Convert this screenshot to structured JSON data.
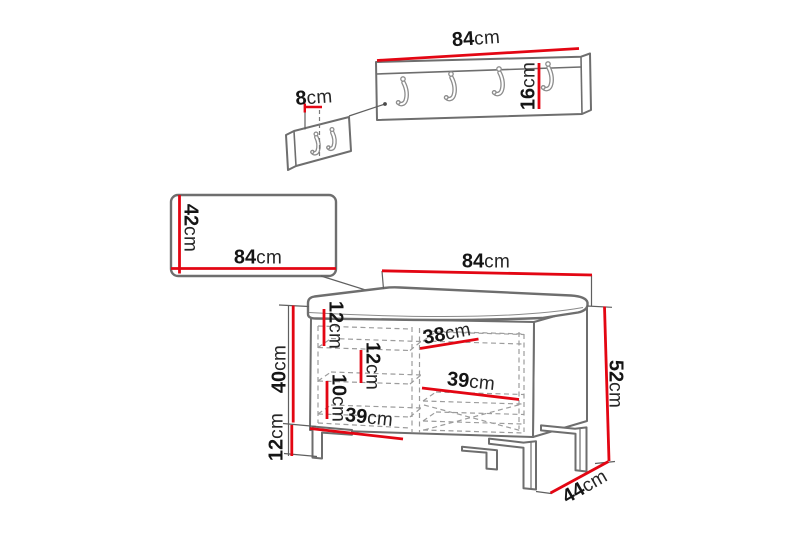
{
  "diagram": {
    "type": "furniture-dimensions",
    "unit": "cm",
    "colors": {
      "dimension_red": "#e30613",
      "outline_gray": "#6e6e6e",
      "dash_gray": "#9c9c9c"
    },
    "coat_rack": {
      "width": {
        "value": "84",
        "unit": "cm"
      },
      "height": {
        "value": "16",
        "unit": "cm"
      },
      "depth": {
        "value": "8",
        "unit": "cm"
      },
      "hook_count": 4,
      "side_view_hook_count": 2
    },
    "wall_panel": {
      "height": {
        "value": "42",
        "unit": "cm"
      },
      "width": {
        "value": "84",
        "unit": "cm"
      }
    },
    "bench": {
      "width": {
        "value": "84",
        "unit": "cm"
      },
      "total_height": {
        "value": "52",
        "unit": "cm"
      },
      "depth": {
        "value": "44",
        "unit": "cm"
      },
      "body_height": {
        "value": "40",
        "unit": "cm"
      },
      "leg_height": {
        "value": "12",
        "unit": "cm"
      },
      "compartment_top_height": {
        "value": "12",
        "unit": "cm"
      },
      "compartment_middle_height": {
        "value": "12",
        "unit": "cm"
      },
      "compartment_bottom_height": {
        "value": "10",
        "unit": "cm"
      },
      "shelf_top_width": {
        "value": "38",
        "unit": "cm"
      },
      "shelf_middle_width": {
        "value": "39",
        "unit": "cm"
      },
      "shelf_bottom_width": {
        "value": "39",
        "unit": "cm"
      }
    }
  }
}
